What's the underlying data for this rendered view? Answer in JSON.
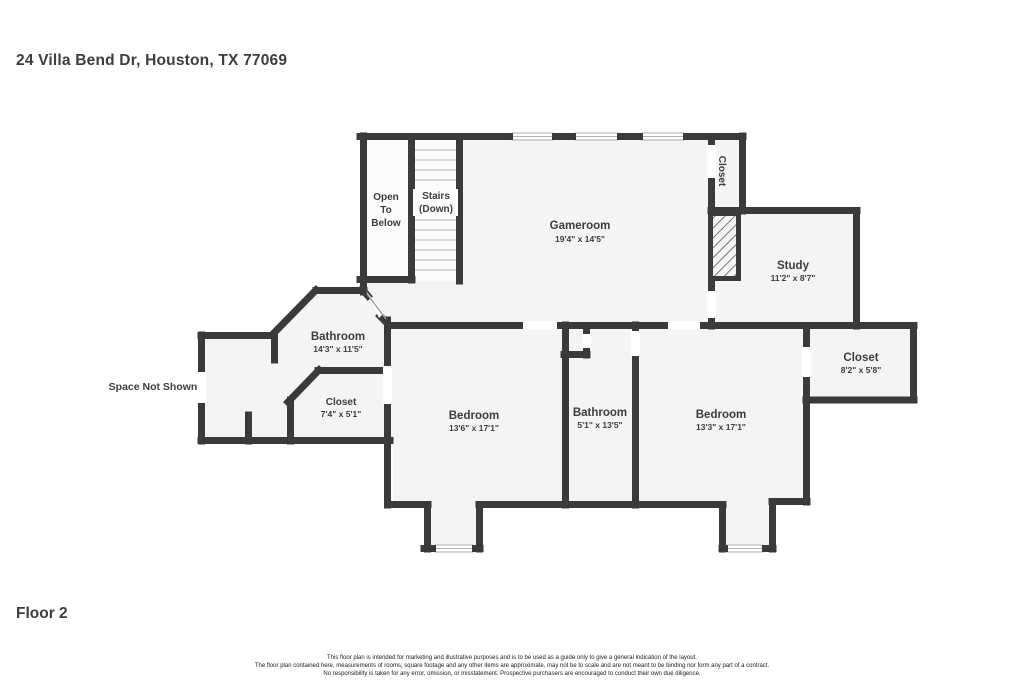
{
  "header": {
    "address": "24 Villa Bend Dr, Houston, TX 77069"
  },
  "footer": {
    "floor_label": "Floor 2"
  },
  "disclaimer": {
    "line1": "This floor plan is intended for marketing and illustrative purposes and is to be used as a guide only to give a general indication of the layout.",
    "line2": "The floor plan contained here, measurements of rooms, square footage and any other items are approximate, may not be to scale and are not meant to be binding nor form any part of a contract.",
    "line3": "No responsibility is taken for any error, omission, or misstatement. Prospective purchasers are encouraged to conduct their own due diligence."
  },
  "plan": {
    "rooms": {
      "gameroom": {
        "name": "Gameroom",
        "dims": "19'4\" x 14'5\""
      },
      "study": {
        "name": "Study",
        "dims": "11'2\" x 8'7\""
      },
      "closet_top": {
        "name": "Closet"
      },
      "closet_right": {
        "name": "Closet",
        "dims": "8'2\" x 5'8\""
      },
      "bathroom_left": {
        "name": "Bathroom",
        "dims": "14'3\" x 11'5\""
      },
      "closet_left": {
        "name": "Closet",
        "dims": "7'4\" x 5'1\""
      },
      "bedroom_left": {
        "name": "Bedroom",
        "dims": "13'6\" x 17'1\""
      },
      "bathroom_center": {
        "name": "Bathroom",
        "dims": "5'1\" x 13'5\""
      },
      "bedroom_right": {
        "name": "Bedroom",
        "dims": "13'3\" x 17'1\""
      },
      "open_to_below": {
        "lines": [
          "Open",
          "To",
          "Below"
        ]
      },
      "stairs": {
        "lines": [
          "Stairs",
          "(Down)"
        ]
      },
      "space_not_shown": {
        "label": "Space Not Shown"
      }
    },
    "colors": {
      "wall": "#3a3a3a",
      "floor": "#f4f4f4",
      "step_line": "#cccccc"
    }
  }
}
